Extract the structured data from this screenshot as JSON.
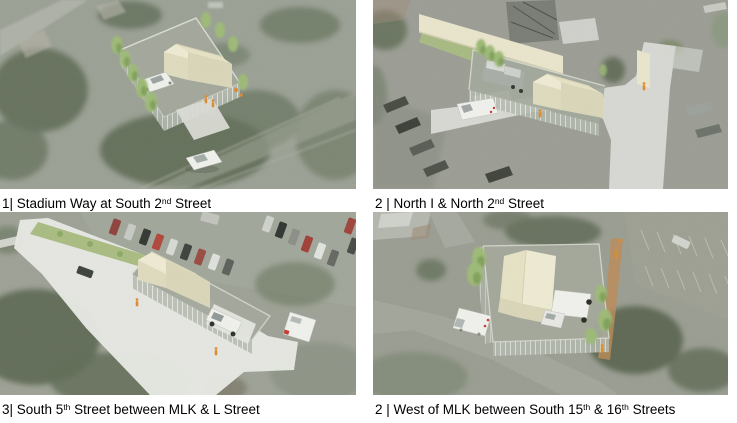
{
  "window": {
    "width": 737,
    "height": 423,
    "background": "#ffffff"
  },
  "header": {
    "clipped_title_fragments": [
      "(",
      ")"
    ]
  },
  "panels": [
    {
      "id": "panel-1",
      "scene": "aerial-rendering-fenced-storage-site",
      "caption": {
        "pre": "1| Stadium Way at South 2",
        "sup1": "nd",
        "mid": " Street",
        "sup2": "",
        "post": ""
      }
    },
    {
      "id": "panel-2",
      "scene": "aerial-rendering-corner-site-with-wall",
      "caption": {
        "pre": "2 | North I & North 2",
        "sup1": "nd",
        "mid": " Street",
        "sup2": "",
        "post": ""
      }
    },
    {
      "id": "panel-3",
      "scene": "aerial-rendering-site-by-parking-lot",
      "caption": {
        "pre": "3| South 5",
        "sup1": "th",
        "mid": " Street between MLK & L Street",
        "sup2": "",
        "post": ""
      }
    },
    {
      "id": "panel-4",
      "scene": "aerial-rendering-site-with-trail",
      "caption": {
        "pre": "2 | West of MLK between South 15",
        "sup1": "th",
        "mid": " & 16",
        "sup2": "th",
        "post": " Streets"
      }
    }
  ],
  "palette": {
    "aerial_base": "#9aa094",
    "dark_foliage": "#5c6852",
    "road_light": "#b2b4aa",
    "render_street": "#dbdcd6",
    "street_white": "#e9eae5",
    "compound_ground": "#a3a89b",
    "building_cream": "#f0ecd4",
    "building_cream_mid": "#e7e3c5",
    "building_cream_shade": "#dbd7b9",
    "building_cream_wall": "#e0dcbf",
    "wall_cream": "#ebe7cd",
    "lawn_green": "#a9bc80",
    "tree_light_green": "#9cba74",
    "tree_mid_green": "#7fa058",
    "figure_orange": "#e08a28",
    "path_tan": "#bd8a54",
    "vehicle_white": "#f2f2ee",
    "red_detail": "#c23830",
    "caption_text": "#000000"
  }
}
